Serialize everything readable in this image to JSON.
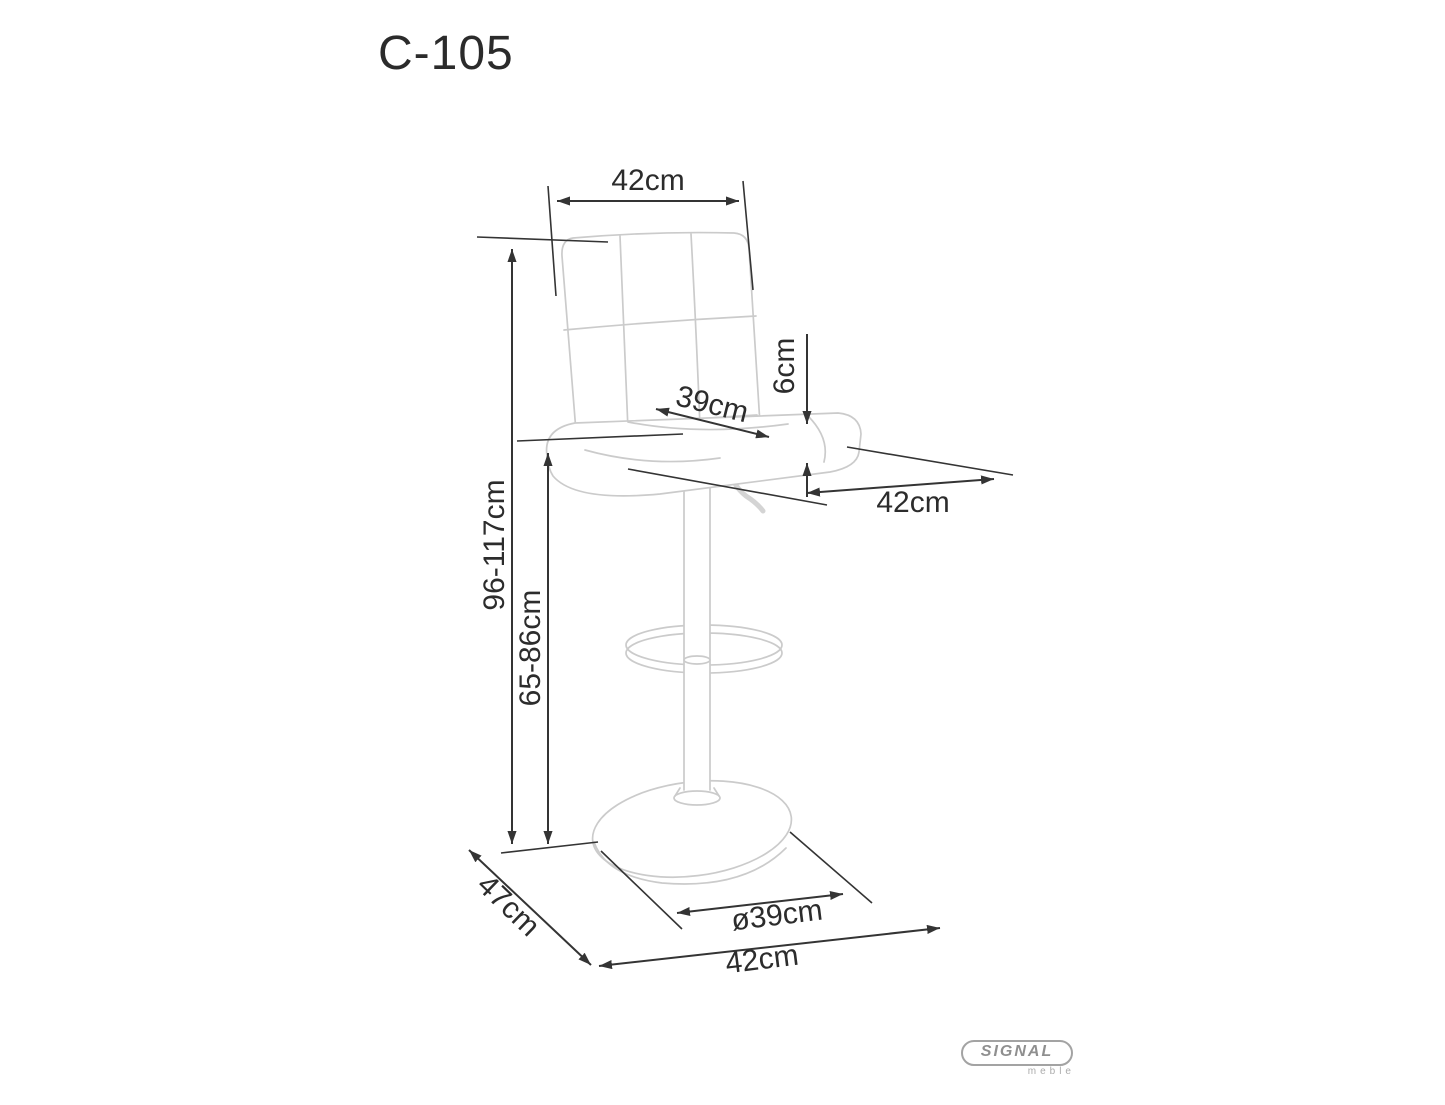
{
  "page": {
    "title": "C-105",
    "background": "#ffffff"
  },
  "drawing": {
    "subject": "height-adjustable quilted bar stool, technical dimension sketch",
    "sketch_line_color": "#cbcbcb",
    "dimension_line_color": "#343434"
  },
  "dimensions": {
    "backrest_width": "42cm",
    "seat_depth": "39cm",
    "seat_cushion_thickness": "6cm",
    "seat_width": "42cm",
    "overall_height": "96-117cm",
    "seat_height": "65-86cm",
    "base_diameter": "ø39cm",
    "footprint_depth": "47cm",
    "footprint_width": "42cm"
  },
  "logo": {
    "brand": "SIGNAL",
    "tagline": "meble",
    "color": "#8f8f8f"
  }
}
